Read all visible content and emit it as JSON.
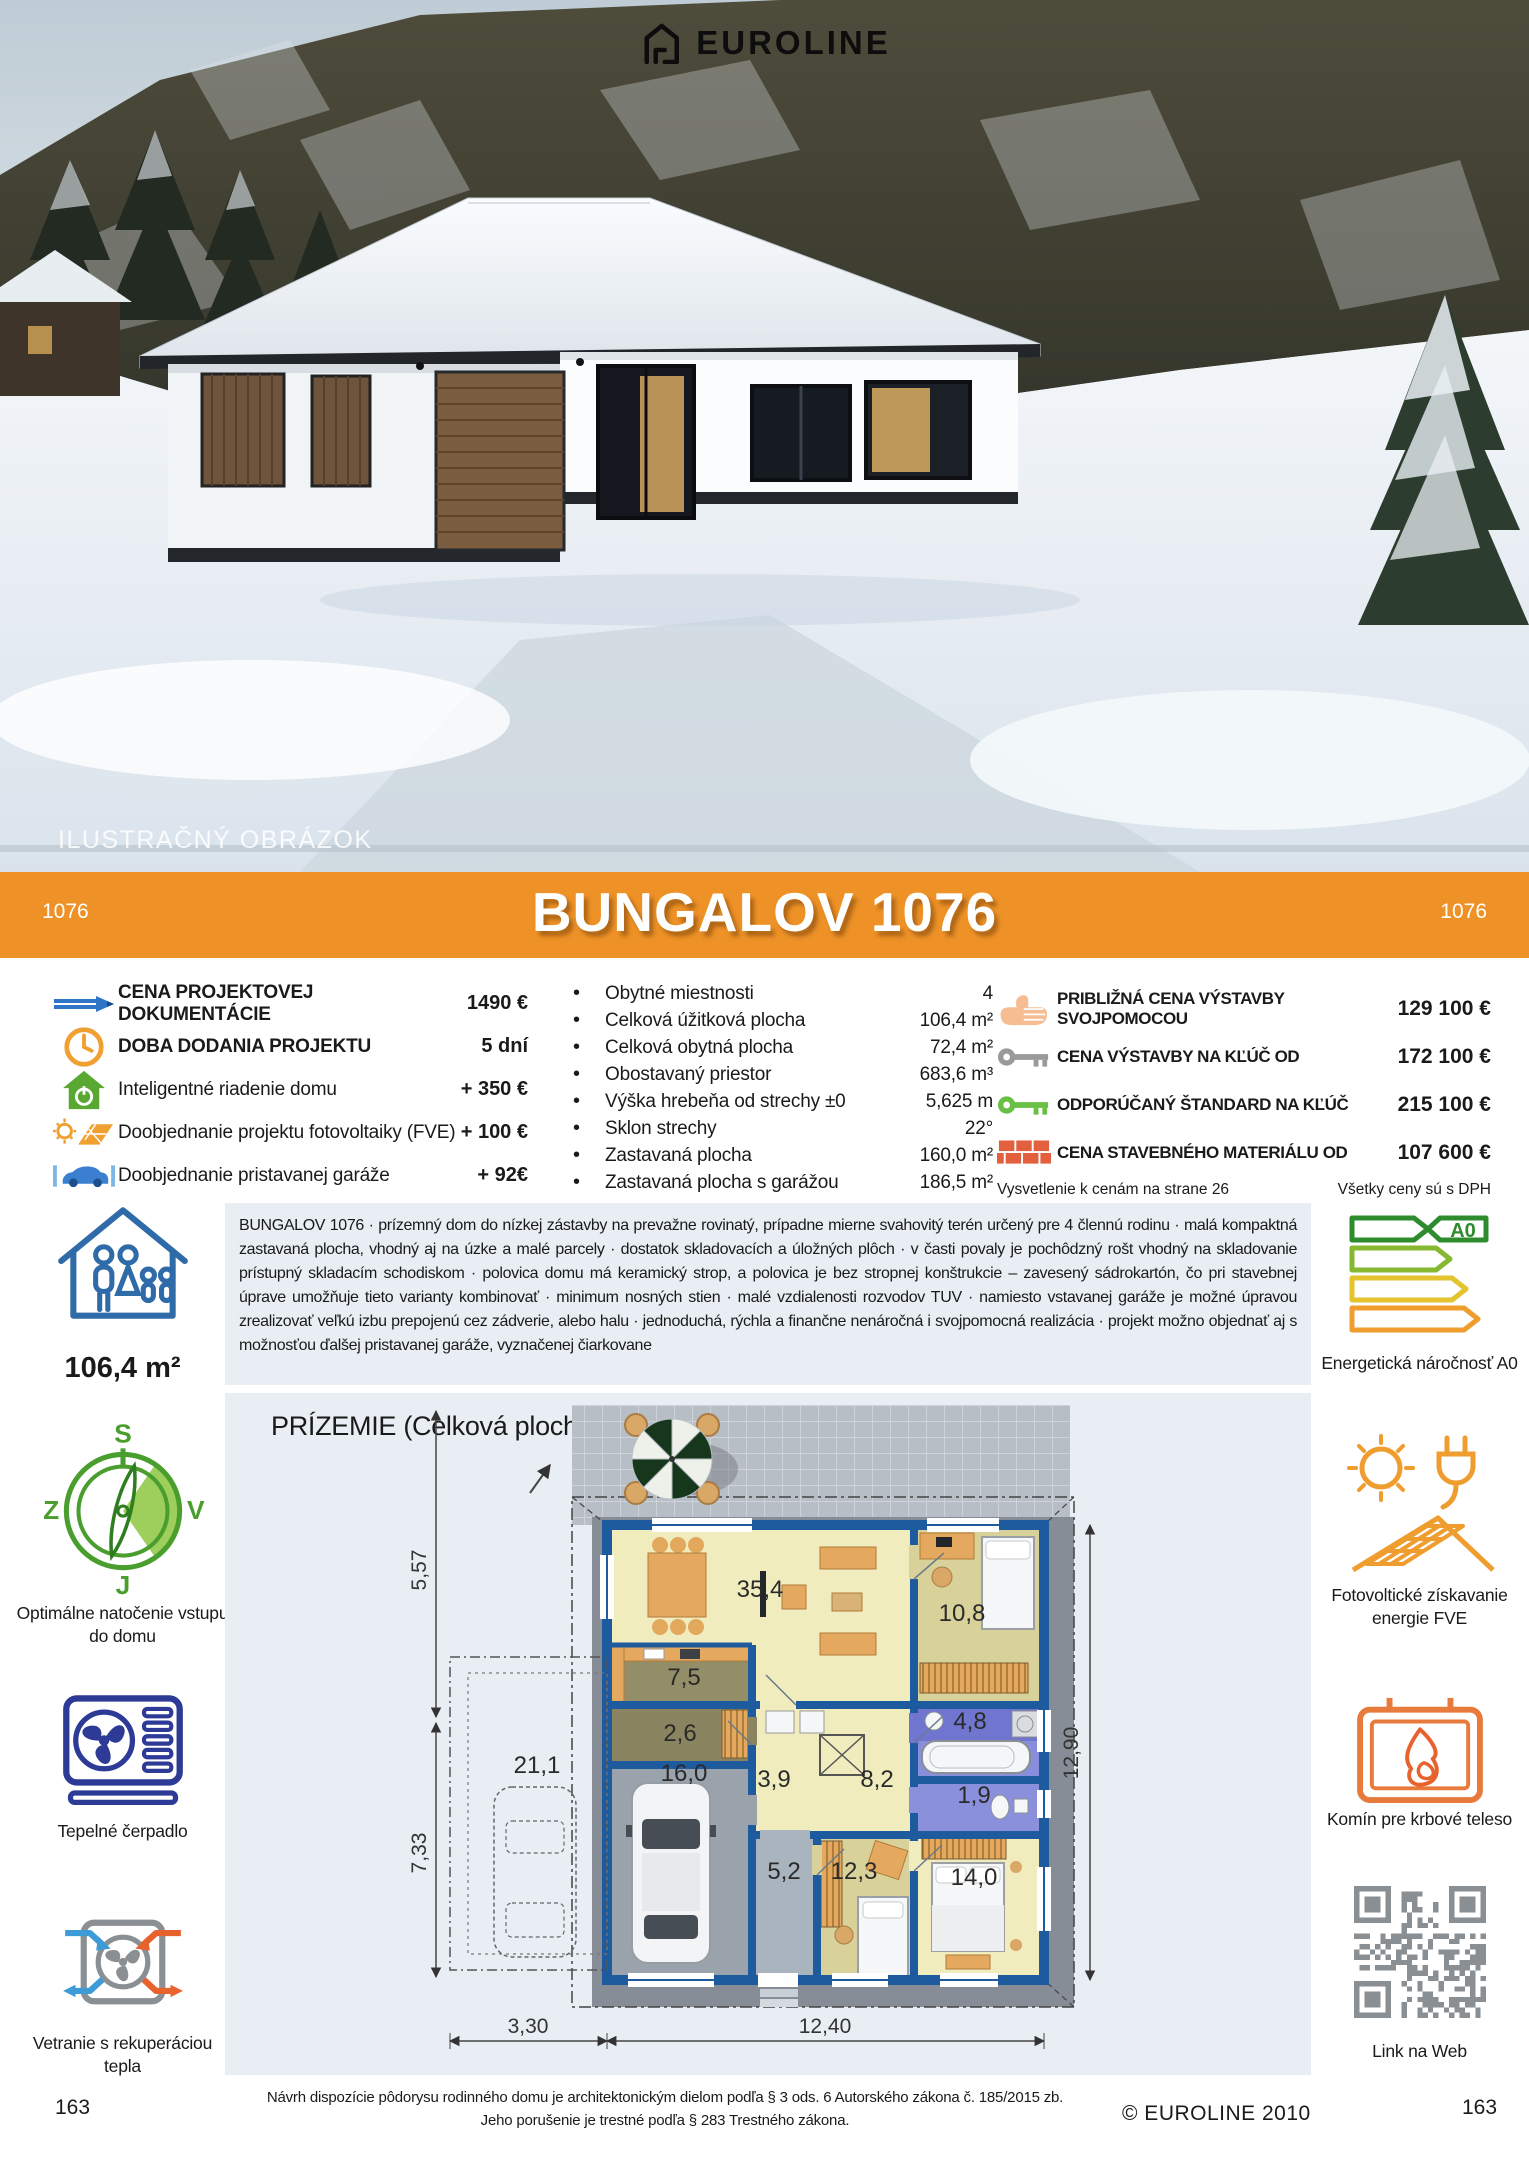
{
  "photo": {
    "logo_text": "EUROLINE",
    "watermark": "ILUSTRAČNÝ OBRÁZOK"
  },
  "banner": {
    "left_code": "1076",
    "title": "BUNGALOV 1076",
    "right_code": "1076",
    "color": "#ee9227"
  },
  "pricing_left": {
    "items": [
      {
        "icon": "pencil-icon",
        "label": "CENA PROJEKTOVEJ DOKUMENTÁCIE",
        "value": "1490 €"
      },
      {
        "icon": "clock-icon",
        "label": "DOBA DODANIA PROJEKTU",
        "value": "5 dní"
      },
      {
        "icon": "smart-home-icon",
        "label": "Inteligentné riadenie domu",
        "value": "+ 350 €"
      },
      {
        "icon": "solar-icon",
        "label": "Doobjednanie projektu fotovoltaiky (FVE)",
        "value": "+ 100 €"
      },
      {
        "icon": "car-icon",
        "label": "Doobjednanie pristavanej garáže",
        "value": "+ 92€"
      }
    ]
  },
  "specs": {
    "items": [
      {
        "label": "Obytné miestnosti",
        "value": "4"
      },
      {
        "label": "Celková úžitková plocha",
        "value": "106,4 m²"
      },
      {
        "label": "Celková obytná plocha",
        "value": "72,4 m²"
      },
      {
        "label": "Obostavaný priestor",
        "value": "683,6 m³"
      },
      {
        "label": "Výška hrebeňa od strechy ±0",
        "value": "5,625 m"
      },
      {
        "label": "Sklon strechy",
        "value": "22°"
      },
      {
        "label": "Zastavaná plocha",
        "value": "160,0 m²"
      },
      {
        "label": "Zastavaná plocha s garážou",
        "value": "186,5 m²"
      }
    ]
  },
  "pricing_right": {
    "items": [
      {
        "icon": "hand-icon",
        "label": "PRIBLIŽNÁ CENA VÝSTAVBY SVOJPOMOCOU",
        "value": "129 100 €"
      },
      {
        "icon": "key-gray-icon",
        "label": "CENA VÝSTAVBY NA KĽÚČ OD",
        "value": "172 100 €"
      },
      {
        "icon": "key-green-icon",
        "label": "ODPORÚČANÝ ŠTANDARD NA KĽÚČ",
        "value": "215 100 €"
      },
      {
        "icon": "bricks-icon",
        "label": "CENA STAVEBNÉHO MATERIÁLU OD",
        "value": "107 600 €"
      }
    ],
    "note_left": "Vysvetlenie k cenám na strane 26",
    "note_right": "Všetky ceny sú s DPH"
  },
  "description": {
    "text": "BUNGALOV 1076 · prízemný dom do nízkej zástavby na prevažne rovinatý, prípadne mierne svahovitý terén určený pre 4 člennú rodinu · malá kompaktná zastavaná plocha, vhodný aj na úzke a malé parcely ·  dostatok skladovacích a úložných plôch · v časti povaly je pochôdzný rošt vhodný na skladovanie prístupný skladacím schodiskom ·  polovica domu má keramický strop, a polovica je bez stropnej konštrukcie – zavesený sádrokartón, čo pri stavebnej úprave umožňuje tieto varianty kombinovať · minimum nosných stien · malé vzdialenosti rozvodov TUV · namiesto vstavanej garáže je možné úpravou zrealizovať veľkú izbu prepojenú cez zádverie, alebo halu · jednoduchá, rýchla a finančne nenáročná i svojpomocná realizácia · projekt možno objednať aj s možnosťou ďalšej pristavanej garáže, vyznačenej čiarkovane"
  },
  "left_rail": {
    "area": "106,4 m²",
    "compass": {
      "n": "S",
      "w": "Z",
      "e": "V",
      "s": "J",
      "caption": "Optimálne natočenie vstupu do domu"
    },
    "heatpump_caption": "Tepelné čerpadlo",
    "vent_caption": "Vetranie s rekuperáciou tepla"
  },
  "right_rail": {
    "energy_label": "A0",
    "energy_caption": "Energetická náročnosť A0",
    "pv_caption": "Fotovoltické získavanie energie FVE",
    "chimney_caption": "Komín pre krbové teleso",
    "qr_caption": "Link na Web"
  },
  "floorplan": {
    "title": "PRÍZEMIE (Celková plocha: 122,4 m²)",
    "rooms": {
      "living": "35,4",
      "kitchen": "7,5",
      "entry": "2,6",
      "garage": "16,0",
      "hall_small": "3,9",
      "hall": "8,2",
      "bedroom1": "10,8",
      "bath": "4,8",
      "wc": "1,9",
      "corridor": "5,2",
      "bedroom2": "12,3",
      "bedroom3": "14,0",
      "garage_opt": "21,1"
    },
    "dims": {
      "left_top": "5,57",
      "left_bottom": "7,33",
      "right": "12,90",
      "bottom_left": "3,30",
      "bottom_right": "12,40"
    }
  },
  "footer": {
    "legal1": "Návrh dispozície pôdorysu rodinného domu je architektonickým dielom podľa § 3 ods. 6 Autorského zákona č. 185/2015 zb.",
    "legal2": "Jeho porušenie je trestné podľa § 283 Trestného zákona.",
    "copyright": "© EUROLINE 2010",
    "page_left": "163",
    "page_right": "163"
  }
}
